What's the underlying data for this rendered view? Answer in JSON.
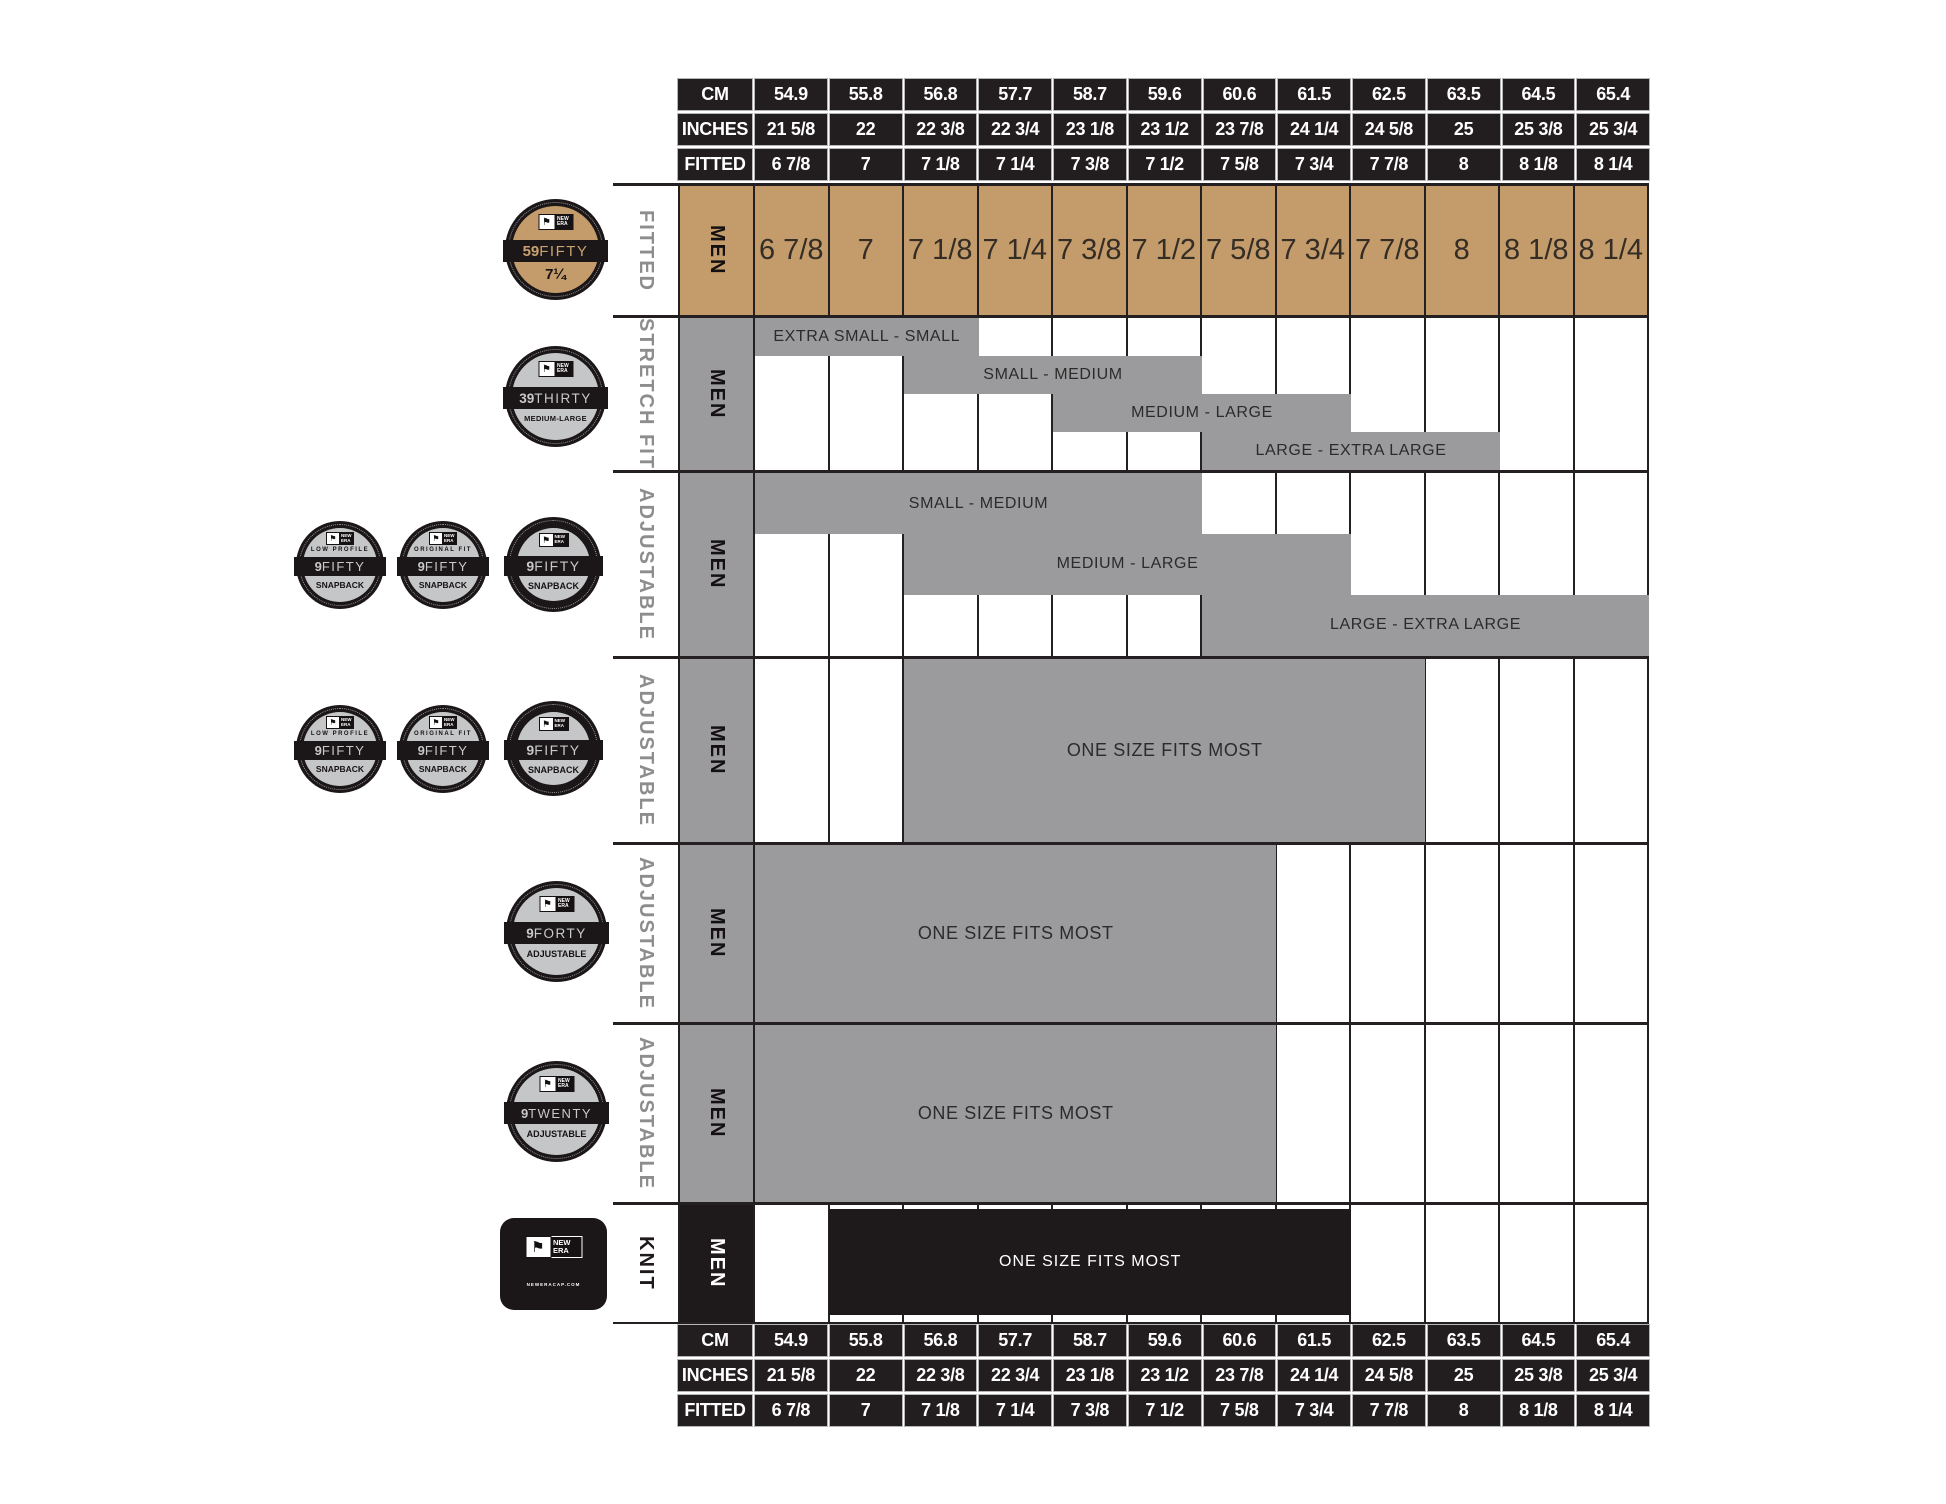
{
  "brand": {
    "name": "NEW ERA",
    "flag_icon": "new-era-flag",
    "site": "NEWERACAP.COM"
  },
  "colors": {
    "tan": "#C49B6A",
    "gray": "#9B9B9D",
    "black": "#1E191A",
    "label_gray": "#8D8D8D",
    "white": "#FFFFFF"
  },
  "axis_labels": {
    "cm": "CM",
    "inches": "INCHES",
    "fitted": "FITTED"
  },
  "columns": {
    "cm": [
      "54.9",
      "55.8",
      "56.8",
      "57.7",
      "58.7",
      "59.6",
      "60.6",
      "61.5",
      "62.5",
      "63.5",
      "64.5",
      "65.4"
    ],
    "inches": [
      "21 5/8",
      "22",
      "22 3/8",
      "22 3/4",
      "23 1/8",
      "23 1/2",
      "23 7/8",
      "24 1/4",
      "24 5/8",
      "25",
      "25 3/8",
      "25 3/4"
    ],
    "fitted": [
      "6 7/8",
      "7",
      "7 1/8",
      "7 1/4",
      "7 3/8",
      "7 1/2",
      "7 5/8",
      "7 3/4",
      "7 7/8",
      "8",
      "8 1/8",
      "8 1/4"
    ]
  },
  "rows": {
    "fitted": {
      "type_label": "FITTED",
      "gender": "MEN",
      "sizes": [
        "6 7/8",
        "7",
        "7 1/8",
        "7 1/4",
        "7 3/8",
        "7 1/2",
        "7 5/8",
        "7 3/4",
        "7 7/8",
        "8",
        "8 1/8",
        "8 1/4"
      ],
      "badge": {
        "prefix": "59",
        "name": "FIFTY",
        "caption": "7¼"
      }
    },
    "stretch": {
      "type_label": "STRETCH FIT",
      "gender": "MEN",
      "badge": {
        "prefix": "39",
        "name": "THIRTY",
        "caption": "MEDIUM-LARGE"
      },
      "bands": [
        {
          "label": "EXTRA SMALL - SMALL",
          "start": 1,
          "span": 3
        },
        {
          "label": "SMALL - MEDIUM",
          "start": 3,
          "span": 4
        },
        {
          "label": "MEDIUM - LARGE",
          "start": 5,
          "span": 4
        },
        {
          "label": "LARGE - EXTRA LARGE",
          "start": 7,
          "span": 4
        }
      ]
    },
    "adjustable_snapback": {
      "type_label": "ADJUSTABLE",
      "gender": "MEN",
      "badges": [
        {
          "top": "LOW PROFILE",
          "prefix": "9",
          "name": "FIFTY",
          "caption": "SNAPBACK"
        },
        {
          "top": "ORIGINAL FIT",
          "prefix": "9",
          "name": "FIFTY",
          "caption": "SNAPBACK"
        },
        {
          "top": "",
          "prefix": "9",
          "name": "FIFTY",
          "caption": "SNAPBACK"
        }
      ],
      "bands": [
        {
          "label": "SMALL - MEDIUM",
          "start": 1,
          "span": 6
        },
        {
          "label": "MEDIUM - LARGE",
          "start": 3,
          "span": 6
        },
        {
          "label": "LARGE - EXTRA LARGE",
          "start": 7,
          "span": 6
        }
      ]
    },
    "adjustable_osfm": {
      "type_label": "ADJUSTABLE",
      "gender": "MEN",
      "badges": [
        {
          "top": "LOW PROFILE",
          "prefix": "9",
          "name": "FIFTY",
          "caption": "SNAPBACK"
        },
        {
          "top": "ORIGINAL FIT",
          "prefix": "9",
          "name": "FIFTY",
          "caption": "SNAPBACK"
        },
        {
          "top": "",
          "prefix": "9",
          "name": "FIFTY",
          "caption": "SNAPBACK"
        }
      ],
      "bands": [
        {
          "label": "ONE SIZE FITS MOST",
          "start": 3,
          "span": 7
        }
      ]
    },
    "adjustable_9forty": {
      "type_label": "ADJUSTABLE",
      "gender": "MEN",
      "badge": {
        "prefix": "9",
        "name": "FORTY",
        "caption": "ADJUSTABLE"
      },
      "bands": [
        {
          "label": "ONE SIZE FITS MOST",
          "start": 1,
          "span": 7
        }
      ]
    },
    "adjustable_9twenty": {
      "type_label": "ADJUSTABLE",
      "gender": "MEN",
      "badge": {
        "prefix": "9",
        "name": "TWENTY",
        "caption": "ADJUSTABLE"
      },
      "bands": [
        {
          "label": "ONE SIZE FITS MOST",
          "start": 1,
          "span": 7
        }
      ]
    },
    "knit": {
      "type_label": "KNIT",
      "gender": "MEN",
      "band": {
        "label": "ONE SIZE FITS MOST",
        "start": 2,
        "span": 7
      }
    }
  },
  "chart_data": {
    "type": "table",
    "columns": {
      "cm": [
        "54.9",
        "55.8",
        "56.8",
        "57.7",
        "58.7",
        "59.6",
        "60.6",
        "61.5",
        "62.5",
        "63.5",
        "64.5",
        "65.4"
      ],
      "inches": [
        "21 5/8",
        "22",
        "22 3/8",
        "22 3/4",
        "23 1/8",
        "23 1/2",
        "23 7/8",
        "24 1/4",
        "24 5/8",
        "25",
        "25 3/8",
        "25 3/4"
      ],
      "fitted": [
        "6 7/8",
        "7",
        "7 1/8",
        "7 1/4",
        "7 3/8",
        "7 1/2",
        "7 5/8",
        "7 3/4",
        "7 7/8",
        "8",
        "8 1/8",
        "8 1/4"
      ]
    },
    "products": [
      {
        "style": "59FIFTY",
        "fit": "FITTED",
        "gender": "MEN",
        "coverage": "individual fitted sizes 6 7/8 through 8 1/4"
      },
      {
        "style": "39THIRTY",
        "fit": "STRETCH FIT",
        "gender": "MEN",
        "coverage": [
          {
            "size": "EXTRA SMALL - SMALL",
            "fitted_range": "6 7/8 - 7 1/8"
          },
          {
            "size": "SMALL - MEDIUM",
            "fitted_range": "7 1/8 - 7 1/2"
          },
          {
            "size": "MEDIUM - LARGE",
            "fitted_range": "7 3/8 - 7 3/4"
          },
          {
            "size": "LARGE - EXTRA LARGE",
            "fitted_range": "7 5/8 - 8"
          }
        ]
      },
      {
        "style": "9FIFTY SNAPBACK",
        "fit": "ADJUSTABLE",
        "gender": "MEN",
        "coverage": [
          {
            "size": "SMALL - MEDIUM",
            "fitted_range": "6 7/8 - 7 1/2"
          },
          {
            "size": "MEDIUM - LARGE",
            "fitted_range": "7 1/8 - 7 3/4"
          },
          {
            "size": "LARGE - EXTRA LARGE",
            "fitted_range": "7 5/8 - 8 1/4"
          }
        ]
      },
      {
        "style": "9FIFTY SNAPBACK",
        "fit": "ADJUSTABLE",
        "gender": "MEN",
        "coverage": [
          {
            "size": "ONE SIZE FITS MOST",
            "fitted_range": "7 1/8 - 7 7/8"
          }
        ]
      },
      {
        "style": "9FORTY",
        "fit": "ADJUSTABLE",
        "gender": "MEN",
        "coverage": [
          {
            "size": "ONE SIZE FITS MOST",
            "fitted_range": "6 7/8 - 7 5/8"
          }
        ]
      },
      {
        "style": "9TWENTY",
        "fit": "ADJUSTABLE",
        "gender": "MEN",
        "coverage": [
          {
            "size": "ONE SIZE FITS MOST",
            "fitted_range": "6 7/8 - 7 5/8"
          }
        ]
      },
      {
        "style": "KNIT",
        "fit": "KNIT",
        "gender": "MEN",
        "coverage": [
          {
            "size": "ONE SIZE FITS MOST",
            "fitted_range": "7 - 7 3/4"
          }
        ]
      }
    ]
  }
}
